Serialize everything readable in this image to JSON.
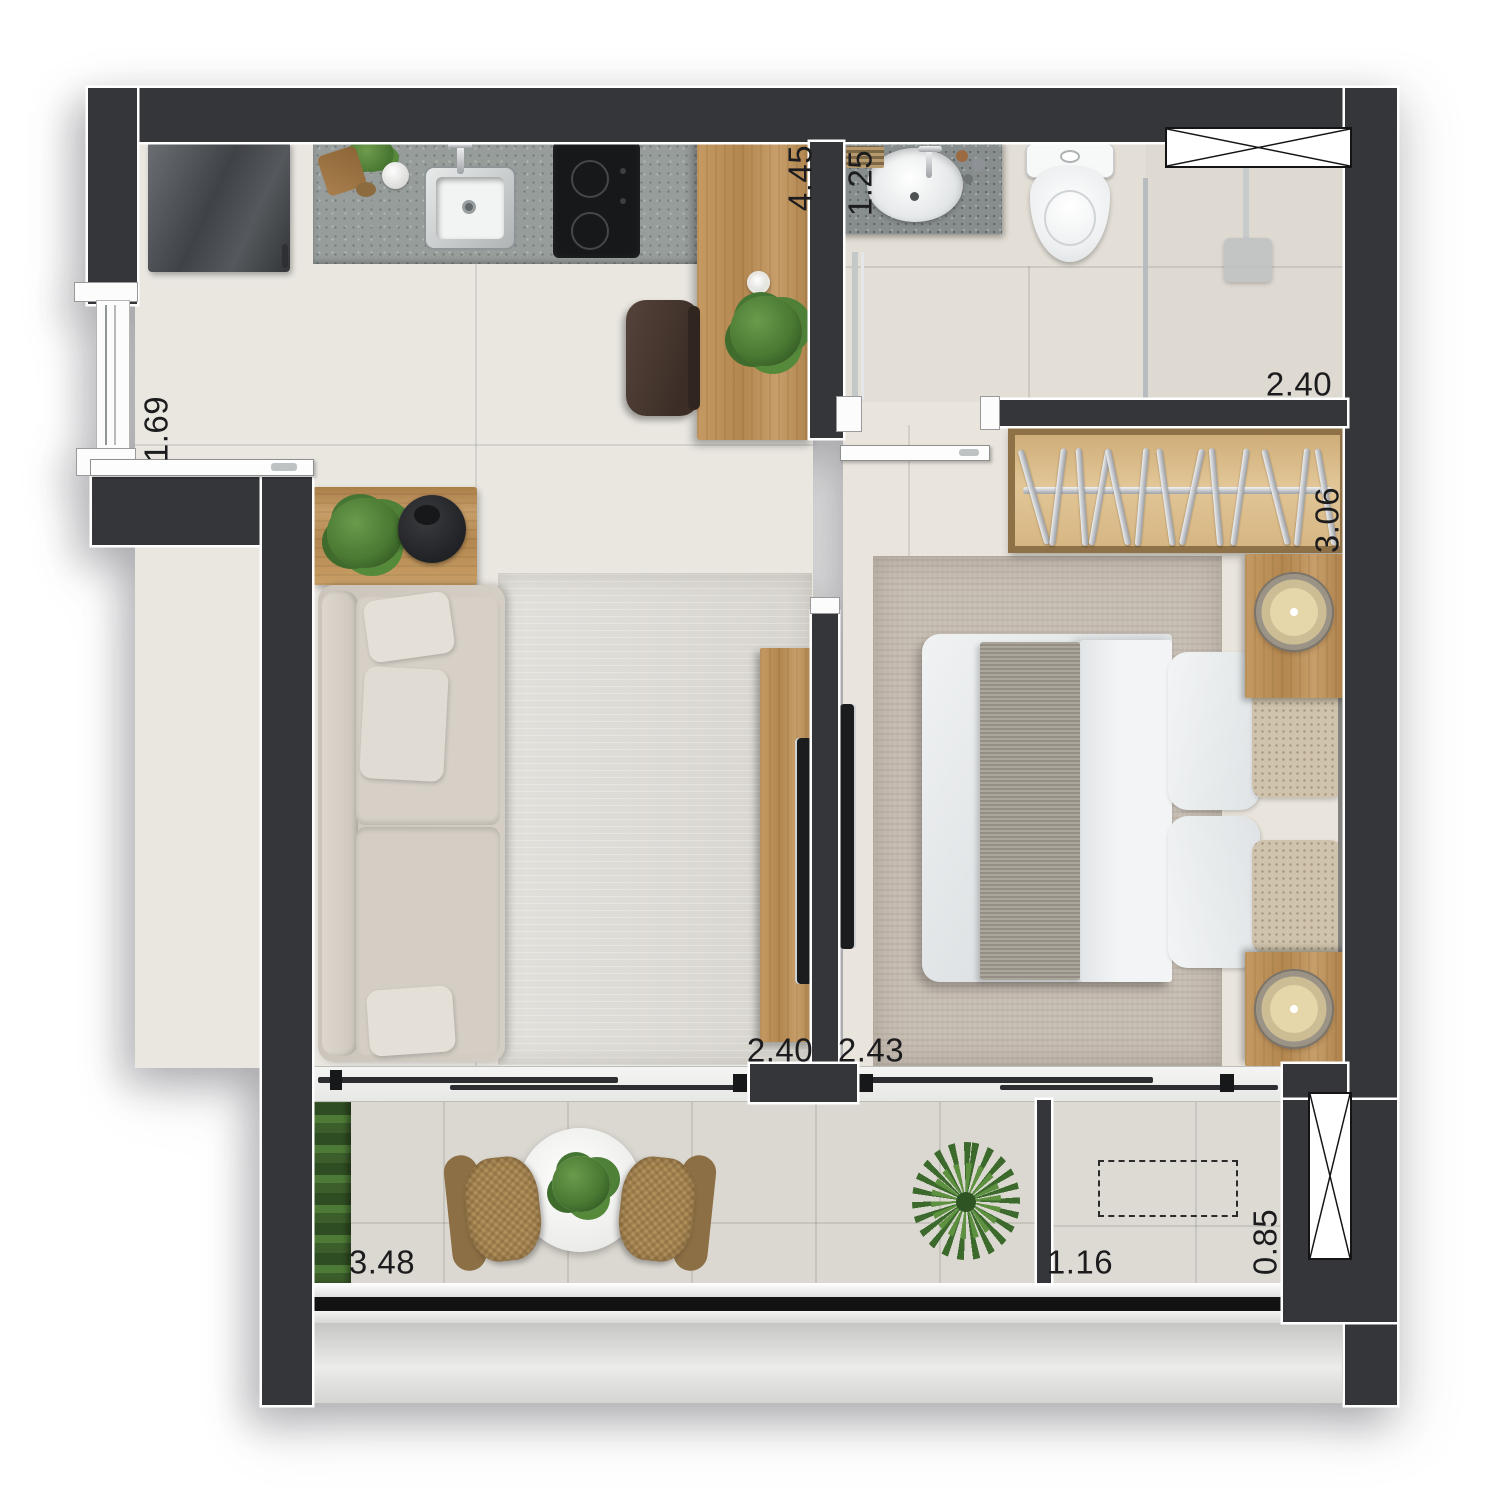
{
  "meta": {
    "type": "floor-plan-render",
    "style": "top-down furnished apartment plan"
  },
  "dimensions": [
    {
      "id": "kitchen-length",
      "value": "4.45",
      "orientation": "vertical"
    },
    {
      "id": "vanity-width",
      "value": "1.25",
      "orientation": "vertical"
    },
    {
      "id": "bathroom-width",
      "value": "2.40",
      "orientation": "horizontal"
    },
    {
      "id": "entry-width",
      "value": "1.69",
      "orientation": "vertical"
    },
    {
      "id": "wardrobe-length",
      "value": "3.06",
      "orientation": "vertical"
    },
    {
      "id": "living-window",
      "value": "2.40",
      "orientation": "horizontal"
    },
    {
      "id": "bedroom-window",
      "value": "2.43",
      "orientation": "horizontal"
    },
    {
      "id": "balcony-length",
      "value": "3.48",
      "orientation": "horizontal"
    },
    {
      "id": "tech-width",
      "value": "1.16",
      "orientation": "horizontal"
    },
    {
      "id": "tech-depth",
      "value": "0.85",
      "orientation": "vertical"
    }
  ],
  "colors": {
    "wall": "#35363a",
    "wall_outline": "#ffffff",
    "wood": "#c59a63",
    "floor_interior": "#eae7e1",
    "floor_bathroom": "#e3dfd7",
    "floor_balcony": "#dbd8d1",
    "countertop": "#979d9b",
    "rug_bedroom": "#c6bdb2",
    "rug_living": "#dfddd6",
    "sofa_fabric": "#d0cac1",
    "plant_green": "#4a7a33",
    "fixture_white": "#f7f8f8",
    "railing_black": "#141414",
    "label_text": "#1c1c1e"
  },
  "objects": [
    "refrigerator",
    "kitchen-counter",
    "kitchen-sink",
    "cooktop",
    "kitchen-desk",
    "stool",
    "bathroom-vanity",
    "toilet",
    "shower",
    "glass-partition",
    "wardrobe-hangers",
    "double-bed",
    "nightstand-lamp",
    "bedroom-rug",
    "sofa",
    "living-rug",
    "coffee-side-table",
    "tv-panel",
    "tv",
    "balcony-dining-table",
    "balcony-chairs",
    "vertical-garden",
    "potted-palm",
    "shaft-x-icon",
    "tech-area-dashed-outline",
    "entry-door",
    "sliding-doors",
    "windows",
    "railing"
  ]
}
